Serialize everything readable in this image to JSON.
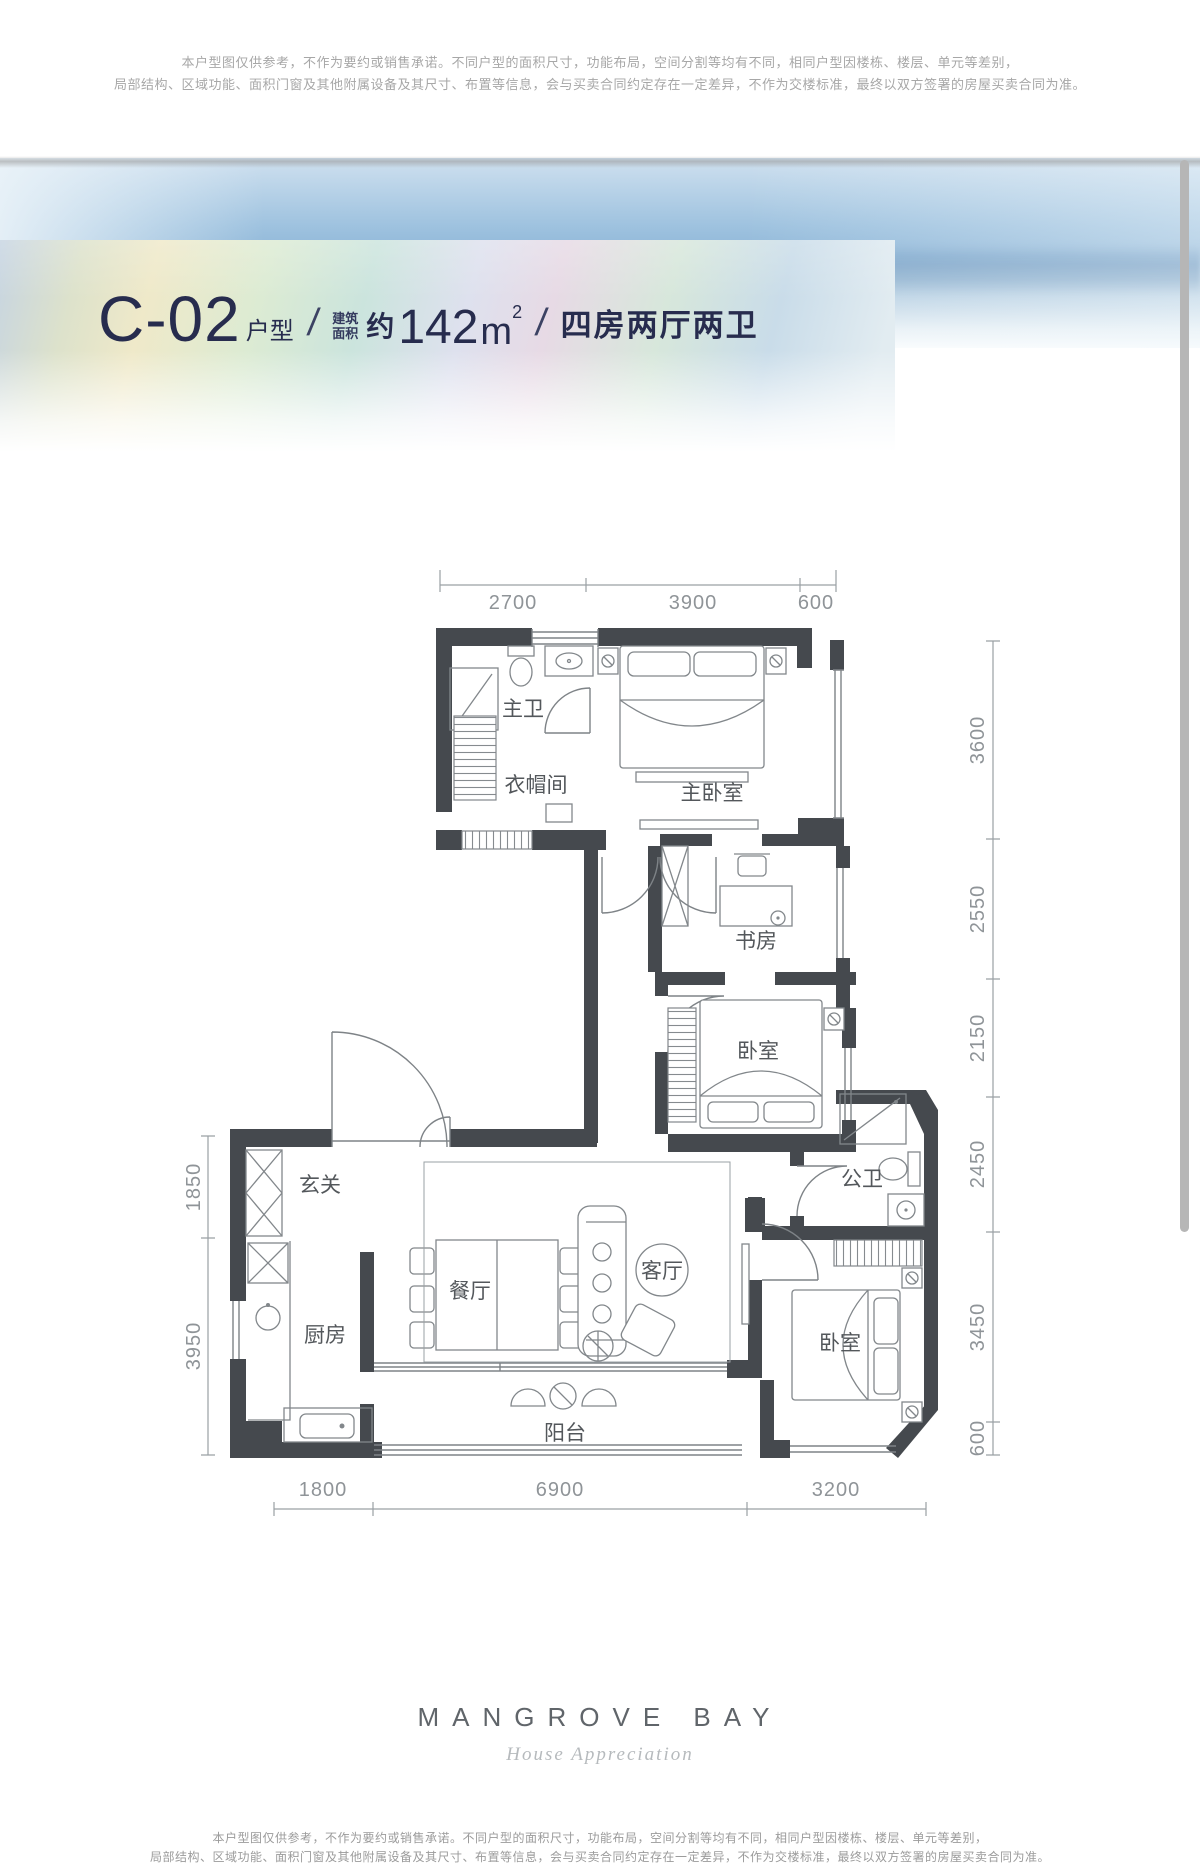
{
  "top_disclaimer": {
    "line1": "本户型图仅供参考，不作为要约或销售承诺。不同户型的面积尺寸，功能布局，空间分割等均有不同，相同户型因楼栋、楼层、单元等差别，",
    "line2": "局部结构、区域功能、面积门窗及其他附属设备及其尺寸、布置等信息，会与买卖合同约定存在一定差异，不作为交楼标准，最终以双方签署的房屋买卖合同为准。"
  },
  "header": {
    "unit_code": "C-02",
    "unit_label": "户型",
    "slash1": "/",
    "area_label_line1": "建筑",
    "area_label_line2": "面积",
    "area_approx": "约",
    "area_value": "142",
    "area_unit": "m",
    "area_sup": "2",
    "slash2": "/",
    "layout_desc": "四房两厅两卫",
    "title_color": "#272c4e"
  },
  "floorplan": {
    "rooms": {
      "master_bath": "主卫",
      "cloakroom": "衣帽间",
      "master_bedroom": "主卧室",
      "study": "书房",
      "bedroom_middle": "卧室",
      "foyer": "玄关",
      "kitchen": "厨房",
      "dining_room": "餐厅",
      "living_room": "客厅",
      "guest_bath": "公卫",
      "bedroom_corner": "卧室",
      "balcony": "阳台"
    },
    "dims": {
      "top": [
        "2700",
        "3900",
        "600"
      ],
      "right": [
        "3600",
        "2550",
        "2150",
        "2450",
        "3450",
        "600"
      ],
      "left": [
        "1850",
        "3950"
      ],
      "bottom": [
        "1800",
        "6900",
        "3200"
      ]
    }
  },
  "footer": {
    "brand": "MANGROVE BAY",
    "tagline": "House Appreciation"
  },
  "bottom_disclaimer": {
    "line1": "本户型图仅供参考，不作为要约或销售承诺。不同户型的面积尺寸，功能布局，空间分割等均有不同，相同户型因楼栋、楼层、单元等差别，",
    "line2": "局部结构、区域功能、面积门窗及其他附属设备及其尺寸、布置等信息，会与买卖合同约定存在一定差异，不作为交楼标准，最终以双方签署的房屋买卖合同为准。"
  }
}
